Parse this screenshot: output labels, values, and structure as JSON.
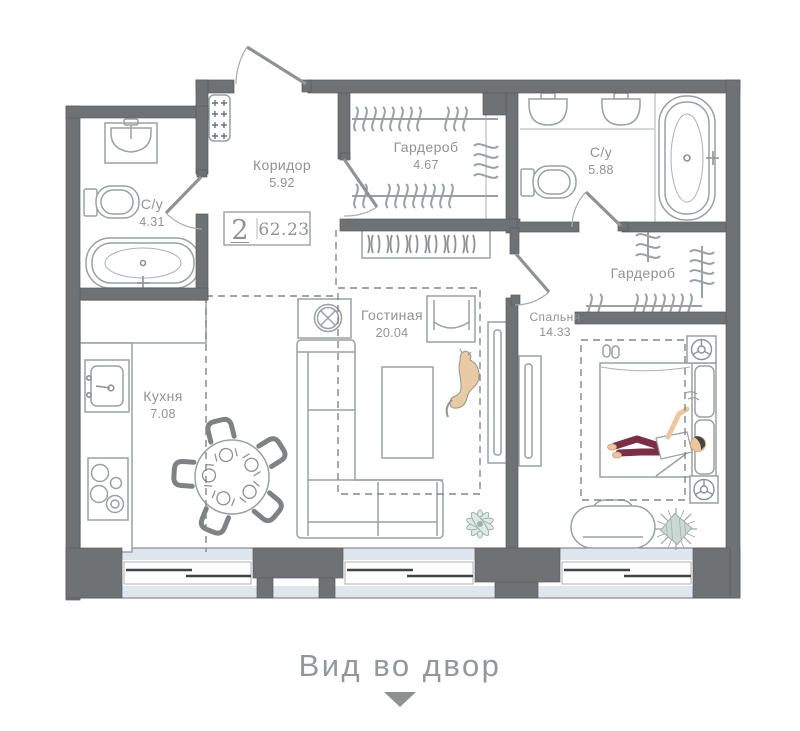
{
  "badge": {
    "rooms_count": "2",
    "total_area": "62.23"
  },
  "rooms": [
    {
      "key": "corridor",
      "name": "Коридор",
      "area": "5.92"
    },
    {
      "key": "wardrobe_hall",
      "name": "Гардероб",
      "area": "4.67"
    },
    {
      "key": "bathroom_main",
      "name": "С/у",
      "area": "5.88"
    },
    {
      "key": "bathroom_guest",
      "name": "С/у",
      "area": "4.31"
    },
    {
      "key": "wardrobe_bedroom",
      "name": "Гардероб",
      "area": ""
    },
    {
      "key": "living",
      "name": "Гостиная",
      "area": "20.04"
    },
    {
      "key": "bedroom",
      "name": "Спальня",
      "area": "14.33"
    },
    {
      "key": "kitchen",
      "name": "Кухня",
      "area": "7.08"
    }
  ],
  "caption": {
    "text": "Вид во двор"
  },
  "icons": [
    "entrance-door",
    "electrical-panel",
    "clothes-hanger",
    "shoe-rack",
    "sink",
    "toilet",
    "bathtub",
    "washing-machine",
    "stove",
    "kitchen-sink",
    "dining-table",
    "chair",
    "sofa",
    "armchair",
    "coffee-table",
    "tv",
    "bed",
    "ceiling-lamp",
    "nightstand",
    "slippers",
    "bench",
    "plant",
    "cat",
    "window",
    "down-arrow"
  ],
  "colors": {
    "wall": "#6e7275",
    "line": "#9aa0a3",
    "line_dark": "#8d9194",
    "text": "#8f9295",
    "glass": "#dfe6ee",
    "window_frame": "#3f4347",
    "pants": "#7c2e44",
    "skin": "#eac79f",
    "hair": "#45453f",
    "cat": "#e8cba5",
    "plant": "#dfe9e5",
    "plant_stroke": "#9db3ab"
  }
}
